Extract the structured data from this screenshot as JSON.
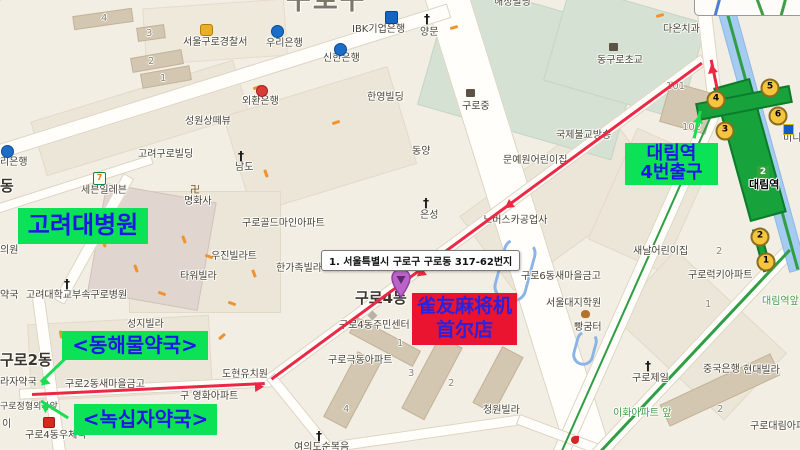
{
  "overlays": {
    "address_tooltip": "1. 서울특별시 구로구 구로동 317-62번지",
    "hospital_box": "고려대병원",
    "station_box": {
      "line1": "대림역",
      "line2": "4번출구"
    },
    "pharmacy_box_1": "<동해물약국>",
    "pharmacy_box_2": "<녹십자약국>",
    "shop_box": {
      "line1": "雀友麻将机",
      "line2": "首尔店"
    },
    "colors": {
      "highlight_green": "#0ce256",
      "overlay_blue": "#1d18e6",
      "shop_red": "#ea1430",
      "route_red": "#ee2744",
      "arrow_green": "#1ade52"
    }
  },
  "subway": {
    "station_name": "대림역",
    "line_badge": "2",
    "stop_label": "대림역앞",
    "exits": [
      {
        "n": "1",
        "x": 766,
        "y": 262
      },
      {
        "n": "2",
        "x": 760,
        "y": 237
      },
      {
        "n": "3",
        "x": 725,
        "y": 131
      },
      {
        "n": "4",
        "x": 716,
        "y": 100
      },
      {
        "n": "5",
        "x": 770,
        "y": 88
      },
      {
        "n": "6",
        "x": 778,
        "y": 116
      }
    ]
  },
  "labels": [
    {
      "t": "구로구",
      "x": 286,
      "y": -14,
      "c": "city"
    },
    {
      "t": "구로4동",
      "x": 355,
      "y": 290,
      "c": "town"
    },
    {
      "t": "구로2동",
      "x": 0,
      "y": 352,
      "c": "town"
    },
    {
      "t": "동",
      "x": 0,
      "y": 178,
      "c": "town"
    },
    {
      "t": "서울구로경찰서",
      "x": 183,
      "y": 37
    },
    {
      "t": "우리은행",
      "x": 266,
      "y": 38
    },
    {
      "t": "신한은행",
      "x": 323,
      "y": 53
    },
    {
      "t": "IBK기업은행",
      "x": 352,
      "y": 24
    },
    {
      "t": "양문",
      "x": 420,
      "y": 27
    },
    {
      "t": "외환은행",
      "x": 242,
      "y": 96
    },
    {
      "t": "한영빌딩",
      "x": 367,
      "y": 92
    },
    {
      "t": "성원상떼뷰",
      "x": 185,
      "y": 116
    },
    {
      "t": "해성빌딩",
      "x": 494,
      "y": -3
    },
    {
      "t": "구로중",
      "x": 462,
      "y": 101
    },
    {
      "t": "동구로초교",
      "x": 597,
      "y": 55
    },
    {
      "t": "다온치과",
      "x": 663,
      "y": 24
    },
    {
      "t": "국제불교방송",
      "x": 556,
      "y": 130
    },
    {
      "t": "문예원어린이집",
      "x": 503,
      "y": 155
    },
    {
      "t": "노버스카공업사",
      "x": 483,
      "y": 215
    },
    {
      "t": "은성",
      "x": 420,
      "y": 210
    },
    {
      "t": "동양",
      "x": 412,
      "y": 146
    },
    {
      "t": "남도",
      "x": 235,
      "y": 162
    },
    {
      "t": "명화사",
      "x": 184,
      "y": 196
    },
    {
      "t": "세븐일레븐",
      "x": 81,
      "y": 185
    },
    {
      "t": "고려구로빌딩",
      "x": 138,
      "y": 149
    },
    {
      "t": "구로골드마인아파트",
      "x": 242,
      "y": 218
    },
    {
      "t": "우진빌라트",
      "x": 211,
      "y": 251
    },
    {
      "t": "타워빌라",
      "x": 180,
      "y": 271
    },
    {
      "t": "한가족빌라",
      "x": 276,
      "y": 263
    },
    {
      "t": "고려대학교부속구로병원",
      "x": 26,
      "y": 290
    },
    {
      "t": "성지빌라",
      "x": 127,
      "y": 319
    },
    {
      "t": "구로2동새마을금고",
      "x": 65,
      "y": 379
    },
    {
      "t": "도현유치원",
      "x": 222,
      "y": 369
    },
    {
      "t": "구 영화아파트",
      "x": 180,
      "y": 391
    },
    {
      "t": "구로정형외과앞",
      "x": 0,
      "y": 403,
      "c": "sm"
    },
    {
      "t": "라자약국",
      "x": 0,
      "y": 377
    },
    {
      "t": "약국",
      "x": 0,
      "y": 290
    },
    {
      "t": "의원",
      "x": 0,
      "y": 245
    },
    {
      "t": "리은행",
      "x": 0,
      "y": 157
    },
    {
      "t": "이",
      "x": 2,
      "y": 419
    },
    {
      "t": "구로4동우체국",
      "x": 25,
      "y": 430
    },
    {
      "t": "구로4동주민센터",
      "x": 339,
      "y": 320
    },
    {
      "t": "구로극동아파트",
      "x": 328,
      "y": 355
    },
    {
      "t": "청원빌라",
      "x": 483,
      "y": 405
    },
    {
      "t": "여의도순복음",
      "x": 294,
      "y": 442
    },
    {
      "t": "서울대지학원",
      "x": 546,
      "y": 298
    },
    {
      "t": "빵굼터",
      "x": 574,
      "y": 322
    },
    {
      "t": "구로6동새마을금고",
      "x": 521,
      "y": 271
    },
    {
      "t": "새날어린이집",
      "x": 633,
      "y": 246
    },
    {
      "t": "구로럭키아파트",
      "x": 688,
      "y": 270
    },
    {
      "t": "구로제일",
      "x": 632,
      "y": 373
    },
    {
      "t": "중국은행",
      "x": 703,
      "y": 364
    },
    {
      "t": "현대빌라",
      "x": 743,
      "y": 365
    },
    {
      "t": "이화아파트 앞",
      "x": 613,
      "y": 408,
      "c": "green"
    },
    {
      "t": "구로대림아파트",
      "x": 750,
      "y": 421
    },
    {
      "t": "미니스톱",
      "x": 783,
      "y": 133
    },
    {
      "t": "대림역앞",
      "x": 762,
      "y": 296,
      "c": "green"
    }
  ],
  "numbers": [
    {
      "n": "4",
      "x": 101,
      "y": 13
    },
    {
      "n": "3",
      "x": 146,
      "y": 28
    },
    {
      "n": "2",
      "x": 148,
      "y": 56
    },
    {
      "n": "1",
      "x": 160,
      "y": 73
    },
    {
      "n": "101",
      "x": 666,
      "y": 81
    },
    {
      "n": "102",
      "x": 682,
      "y": 122
    },
    {
      "n": "1",
      "x": 397,
      "y": 338
    },
    {
      "n": "3",
      "x": 408,
      "y": 368
    },
    {
      "n": "2",
      "x": 448,
      "y": 378
    },
    {
      "n": "4",
      "x": 343,
      "y": 404
    },
    {
      "n": "1",
      "x": 705,
      "y": 299
    },
    {
      "n": "2",
      "x": 716,
      "y": 246
    },
    {
      "n": "2",
      "x": 717,
      "y": 404
    }
  ],
  "icons": [
    {
      "t": "police",
      "x": 200,
      "y": 24
    },
    {
      "t": "bank",
      "x": 271,
      "y": 25
    },
    {
      "t": "bank",
      "x": 334,
      "y": 43
    },
    {
      "t": "banksq",
      "x": 385,
      "y": 11
    },
    {
      "t": "cross",
      "x": 424,
      "y": 14
    },
    {
      "t": "bankr",
      "x": 256,
      "y": 85
    },
    {
      "t": "school",
      "x": 466,
      "y": 89
    },
    {
      "t": "school",
      "x": 609,
      "y": 43
    },
    {
      "t": "cross",
      "x": 238,
      "y": 151
    },
    {
      "t": "manji",
      "x": 190,
      "y": 186
    },
    {
      "t": "seven",
      "x": 93,
      "y": 172
    },
    {
      "t": "cross",
      "x": 423,
      "y": 198
    },
    {
      "t": "cross",
      "x": 64,
      "y": 279
    },
    {
      "t": "post",
      "x": 43,
      "y": 417
    },
    {
      "t": "cross",
      "x": 645,
      "y": 361
    },
    {
      "t": "cross",
      "x": 316,
      "y": 431
    },
    {
      "t": "bakery",
      "x": 581,
      "y": 310
    },
    {
      "t": "bank",
      "x": 1,
      "y": 145
    },
    {
      "t": "mstop",
      "x": 783,
      "y": 124
    },
    {
      "t": "poi",
      "x": 571,
      "y": 436
    },
    {
      "t": "diamond",
      "x": 369,
      "y": 312
    }
  ],
  "oneway_marks": [
    {
      "x": 450,
      "y": 26,
      "a": -15
    },
    {
      "x": 253,
      "y": 86,
      "a": -20
    },
    {
      "x": 332,
      "y": 121,
      "a": -18
    },
    {
      "x": 656,
      "y": 14,
      "a": -15
    },
    {
      "x": 100,
      "y": 242,
      "a": 70
    },
    {
      "x": 132,
      "y": 267,
      "a": 70
    },
    {
      "x": 158,
      "y": 292,
      "a": 20
    },
    {
      "x": 228,
      "y": 302,
      "a": 20
    },
    {
      "x": 250,
      "y": 272,
      "a": 70
    },
    {
      "x": 57,
      "y": 333,
      "a": 80
    },
    {
      "x": 205,
      "y": 255,
      "a": 20
    },
    {
      "x": 180,
      "y": 238,
      "a": 70
    },
    {
      "x": 262,
      "y": 172,
      "a": 70
    },
    {
      "x": 218,
      "y": 335,
      "a": -40
    }
  ]
}
